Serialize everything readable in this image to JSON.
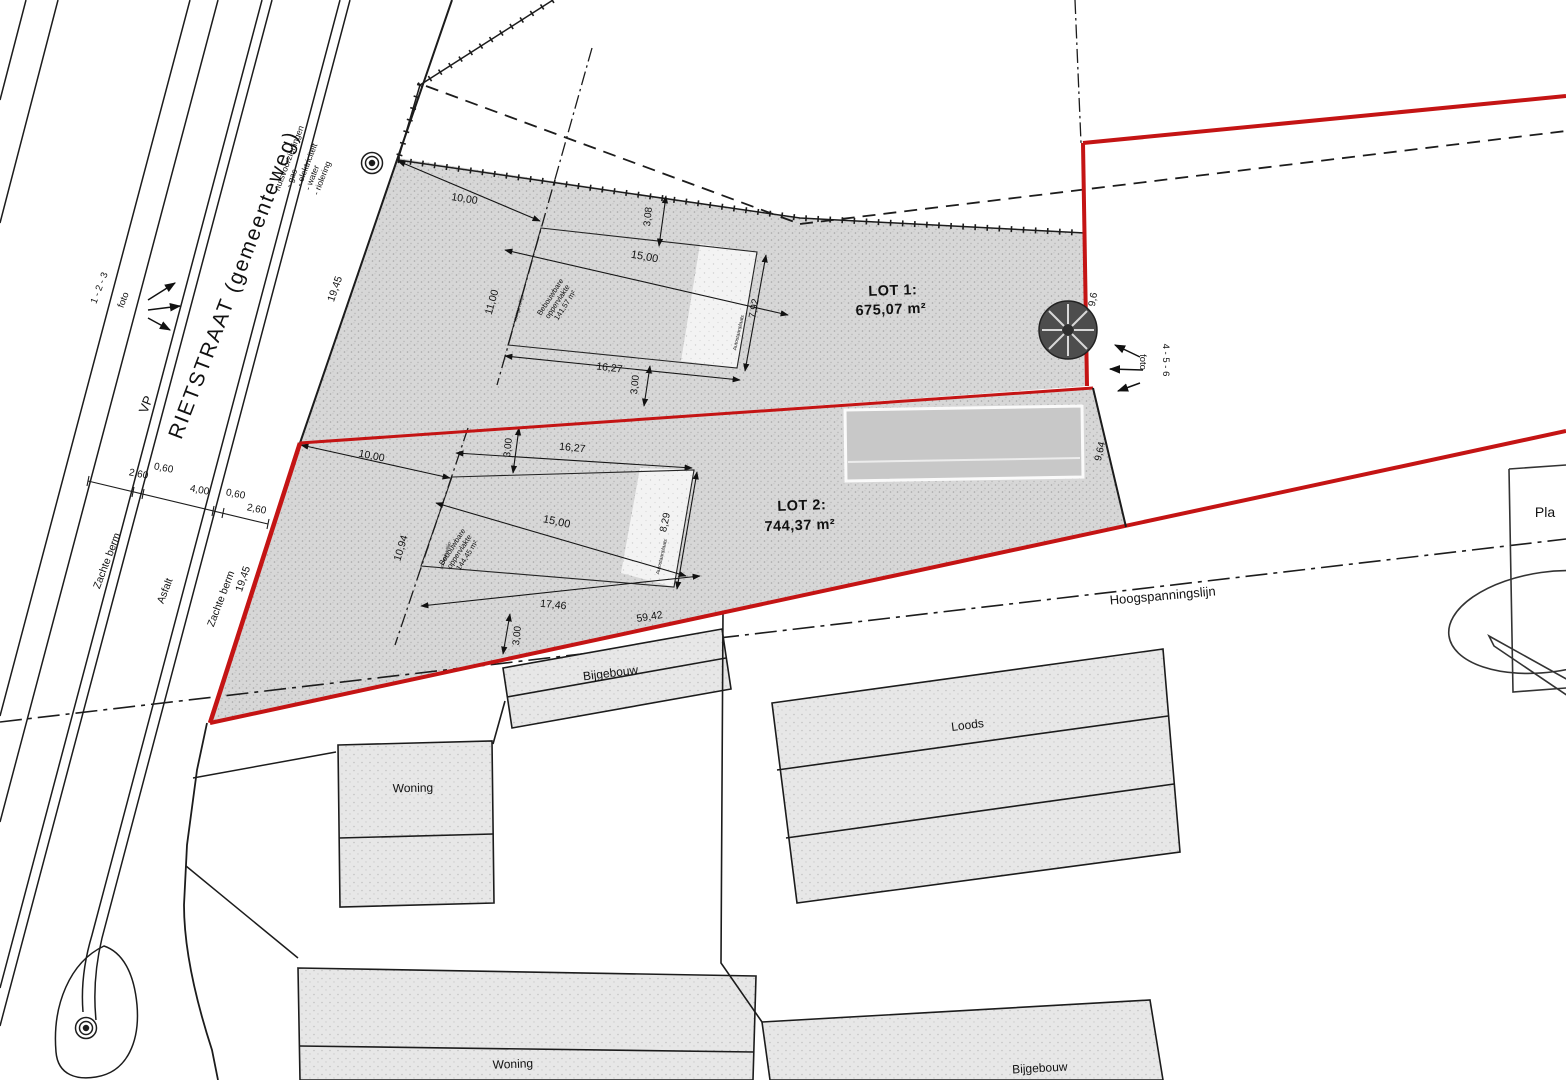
{
  "street": {
    "name": "RIETSTRAAT (gemeenteweg)",
    "marker": "VP",
    "left_berm": "Zachte berm",
    "asphalt": "Asfalt",
    "right_berm": "Zachte berm",
    "utilities_header": "nutsvoorzieningen",
    "utilities": [
      "- gas",
      "- elektriciteit",
      "- water",
      "- riolering"
    ],
    "cross_dims": [
      "2,60",
      "0,60",
      "4,00",
      "0,60",
      "2,60"
    ]
  },
  "photos": {
    "left_numbers": "1 - 2 - 3",
    "left_label": "foto",
    "right_numbers": "4 - 5 - 6",
    "right_label": "foto"
  },
  "lot1": {
    "title": "LOT 1:",
    "area": "675,07 m²",
    "frontage": "19,45",
    "buildable_line1": "Bebouwbare",
    "buildable_line2": "oppervlakte",
    "buildable_area": "141,57 m²",
    "strip_label": "Autostaanplaats",
    "building_line_label": "voorgevellijn",
    "dims": {
      "d10": "10,00",
      "d11": "11,00",
      "d15": "15,00",
      "d308": "3,08",
      "d792": "7,92",
      "d1627": "16,27",
      "d300": "3,00",
      "d96": "9,6"
    }
  },
  "lot2": {
    "title": "LOT 2:",
    "area": "744,37 m²",
    "frontage": "19,45",
    "buildable_line1": "Bebouwbare",
    "buildable_line2": "oppervlakte",
    "buildable_area": "144,45 m²",
    "strip_label": "Autostaanplaats",
    "building_line_label": "voorgevellijn",
    "dims": {
      "d10": "10,00",
      "d1094": "10,94",
      "d15": "15,00",
      "d300t": "3,00",
      "d829": "8,29",
      "d1627": "16,27",
      "d1746": "17,46",
      "d300b": "3,00",
      "d5942": "59,42",
      "d964": "9,64"
    }
  },
  "power_line_label": "Hoogspanningslijn",
  "buildings": {
    "bijgebouw1": "Bijgebouw",
    "woning1": "Woning",
    "loods": "Loods",
    "woning2": "Woning",
    "bijgebouw2": "Bijgebouw"
  },
  "right_box_label": "Pla",
  "colors": {
    "boundary_red": "#c41414",
    "line_black": "#1c1c1c",
    "parcel_fill": "#d7d7d7"
  }
}
